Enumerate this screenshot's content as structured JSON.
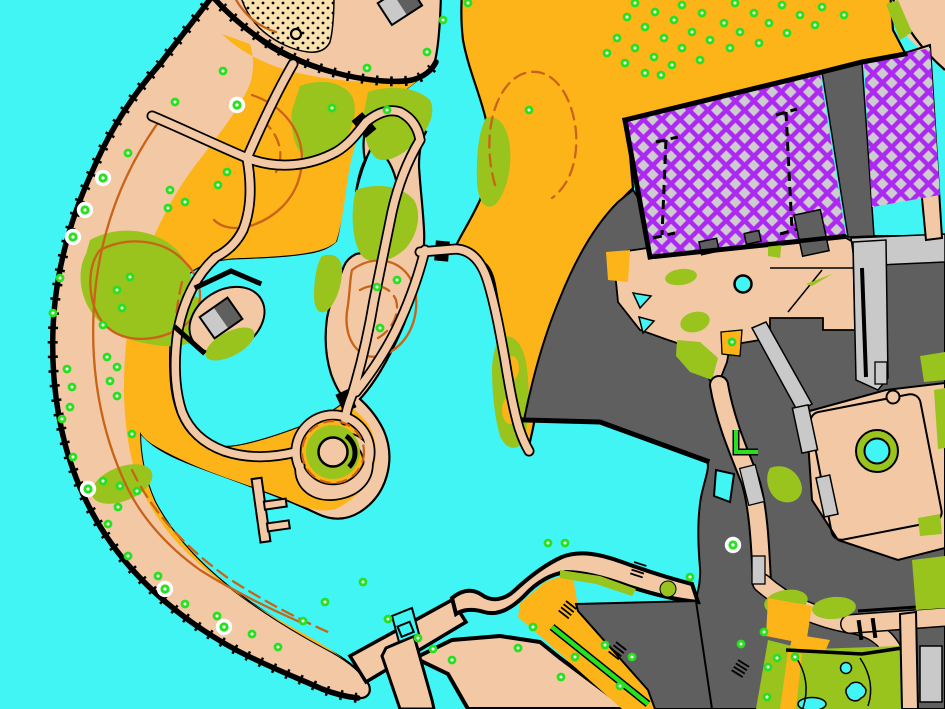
{
  "map": {
    "name": "orienteering-sprint-map",
    "width": 945,
    "height": 709,
    "style": "ISSprOM sprint orienteering map of a waterfront park and resort complex"
  },
  "colors": {
    "water": "#42F5F5",
    "open": "#FDB418",
    "paved": "#F2C9A4",
    "sand": "#FAE2AE",
    "olive": "#99C31D",
    "bright": "#27E01F",
    "contour": "#C96318",
    "bldg": "#5F5F5F",
    "canopy": "#C9C9C9",
    "oob": "#AC29F2",
    "oobbg": "#CFCCCF",
    "ink": "#000000",
    "white": "#FFFFFF"
  },
  "legend": [
    {
      "id": "water",
      "label": "water / lake",
      "color": "#42F5F5"
    },
    {
      "id": "open-land",
      "label": "open land (park grass)",
      "color": "#FDB418"
    },
    {
      "id": "paved",
      "label": "paved area / promenade",
      "color": "#F2C9A4"
    },
    {
      "id": "sand",
      "label": "open sandy beach",
      "color": "#FAE2AE"
    },
    {
      "id": "vegetation",
      "label": "dense vegetation / flowerbeds",
      "color": "#99C31D"
    },
    {
      "id": "tree",
      "label": "single tree",
      "color": "#27E01F"
    },
    {
      "id": "prominent-tree",
      "label": "prominent tree (white halo)",
      "color": "#FFFFFF"
    },
    {
      "id": "building",
      "label": "building",
      "color": "#5F5F5F"
    },
    {
      "id": "canopy",
      "label": "canopy / passable structure",
      "color": "#C9C9C9"
    },
    {
      "id": "out-of-bounds",
      "label": "out-of-bounds construction area (purple crosshatch)",
      "color": "#AC29F2"
    },
    {
      "id": "contour",
      "label": "contour / form line",
      "color": "#C96318"
    },
    {
      "id": "wall",
      "label": "wall / cliff edge with ticks",
      "color": "#000000"
    }
  ],
  "features": {
    "tree_count": 102,
    "prominent_tree_count": 8,
    "trees": [
      [
        223,
        71
      ],
      [
        175,
        102
      ],
      [
        128,
        153
      ],
      [
        227,
        172
      ],
      [
        170,
        190
      ],
      [
        218,
        185
      ],
      [
        185,
        202
      ],
      [
        168,
        208
      ],
      [
        332,
        108
      ],
      [
        387,
        110
      ],
      [
        367,
        68
      ],
      [
        427,
        52
      ],
      [
        443,
        20
      ],
      [
        468,
        3
      ],
      [
        60,
        278
      ],
      [
        130,
        277
      ],
      [
        117,
        290
      ],
      [
        122,
        308
      ],
      [
        53,
        313
      ],
      [
        103,
        325
      ],
      [
        397,
        280
      ],
      [
        377,
        287
      ],
      [
        380,
        328
      ],
      [
        67,
        369
      ],
      [
        107,
        357
      ],
      [
        117,
        367
      ],
      [
        72,
        387
      ],
      [
        110,
        381
      ],
      [
        70,
        407
      ],
      [
        62,
        419
      ],
      [
        117,
        396
      ],
      [
        132,
        434
      ],
      [
        103,
        481
      ],
      [
        120,
        486
      ],
      [
        137,
        491
      ],
      [
        118,
        507
      ],
      [
        108,
        524
      ],
      [
        73,
        457
      ],
      [
        128,
        556
      ],
      [
        158,
        576
      ],
      [
        185,
        604
      ],
      [
        217,
        616
      ],
      [
        252,
        634
      ],
      [
        278,
        647
      ],
      [
        303,
        621
      ],
      [
        325,
        602
      ],
      [
        363,
        582
      ],
      [
        388,
        619
      ],
      [
        418,
        638
      ],
      [
        433,
        649
      ],
      [
        452,
        660
      ],
      [
        518,
        648
      ],
      [
        533,
        627
      ],
      [
        548,
        543
      ],
      [
        565,
        543
      ],
      [
        575,
        657
      ],
      [
        561,
        677
      ],
      [
        620,
        686
      ],
      [
        605,
        645
      ],
      [
        632,
        657
      ],
      [
        529,
        110
      ],
      [
        777,
        658
      ],
      [
        795,
        657
      ],
      [
        741,
        644
      ],
      [
        764,
        632
      ],
      [
        768,
        667
      ],
      [
        767,
        697
      ],
      [
        732,
        342
      ],
      [
        690,
        577
      ],
      [
        635,
        3
      ],
      [
        655,
        12
      ],
      [
        682,
        5
      ],
      [
        702,
        13
      ],
      [
        735,
        3
      ],
      [
        754,
        13
      ],
      [
        782,
        5
      ],
      [
        800,
        15
      ],
      [
        822,
        7
      ],
      [
        844,
        15
      ],
      [
        627,
        17
      ],
      [
        645,
        27
      ],
      [
        674,
        20
      ],
      [
        692,
        32
      ],
      [
        724,
        23
      ],
      [
        740,
        32
      ],
      [
        769,
        23
      ],
      [
        787,
        33
      ],
      [
        815,
        25
      ],
      [
        617,
        38
      ],
      [
        635,
        48
      ],
      [
        664,
        38
      ],
      [
        682,
        48
      ],
      [
        710,
        40
      ],
      [
        730,
        48
      ],
      [
        759,
        43
      ],
      [
        607,
        53
      ],
      [
        625,
        63
      ],
      [
        654,
        57
      ],
      [
        672,
        65
      ],
      [
        700,
        60
      ],
      [
        645,
        73
      ],
      [
        661,
        75
      ]
    ],
    "prominent_trees": [
      [
        237,
        105
      ],
      [
        103,
        178
      ],
      [
        85,
        210
      ],
      [
        73,
        237
      ],
      [
        88,
        489
      ],
      [
        165,
        589
      ],
      [
        224,
        627
      ],
      [
        733,
        545
      ]
    ]
  }
}
